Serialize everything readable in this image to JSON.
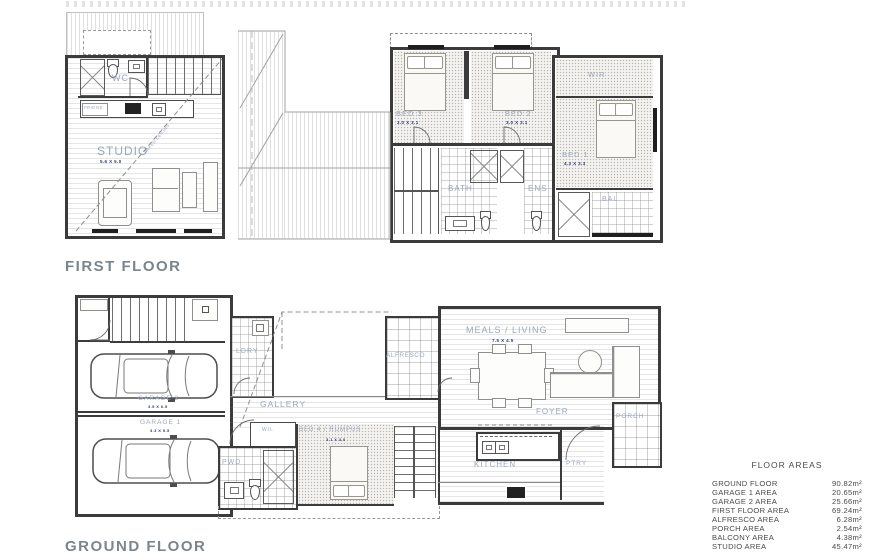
{
  "titles": {
    "first_floor": "FIRST FLOOR",
    "ground_floor": "GROUND FLOOR"
  },
  "first_floor": {
    "studio": {
      "label": "STUDIO",
      "dim": "5.6 X 5.0",
      "annotation": "RAKED CEILING"
    },
    "wc": "WC",
    "fridge": "FRIDGE",
    "bed3": {
      "label": "BED 3",
      "dim": "3.0 X 3.1"
    },
    "bed2": {
      "label": "BED 2",
      "dim": "3.0 X 3.1"
    },
    "bed1": {
      "label": "BED 1",
      "dim": "4.3 X 3.3"
    },
    "wir": "WIR",
    "bath": "BATH",
    "ens": "ENS",
    "bal": "BAL."
  },
  "ground_floor": {
    "garage2": {
      "label": "GARAGE 2",
      "dim": "3.5 X 6.5"
    },
    "garage1": {
      "label": "GARAGE 1",
      "dim": "3.3 X 5.5"
    },
    "ldry": "LDRY",
    "gallery": "GALLERY",
    "wil": "WIL",
    "pwd": "PWD",
    "bed4": {
      "label": "BED 4 / RUMPUS",
      "dim": "3.1 X 3.0"
    },
    "alfresco": "ALFRESCO",
    "meals": {
      "label": "MEALS / LIVING",
      "dim": "7.5 X 4.5"
    },
    "foyer": "FOYER",
    "porch": "PORCH",
    "kitchen": "KITCHEN",
    "ptry": "PTRY"
  },
  "floor_areas": {
    "title": "FLOOR AREAS",
    "rows": [
      {
        "label": "GROUND FLOOR",
        "value": "90.82m²"
      },
      {
        "label": "GARAGE 1 AREA",
        "value": "20.65m²"
      },
      {
        "label": "GARAGE 2 AREA",
        "value": "25.66m²"
      },
      {
        "label": "FIRST FLOOR AREA",
        "value": "69.24m²"
      },
      {
        "label": "ALFRESCO AREA",
        "value": "6.28m²"
      },
      {
        "label": "PORCH AREA",
        "value": "2.54m²"
      },
      {
        "label": "BALCONY AREA",
        "value": "4.38m²"
      },
      {
        "label": "STUDIO AREA",
        "value": "45.47m²"
      }
    ]
  }
}
